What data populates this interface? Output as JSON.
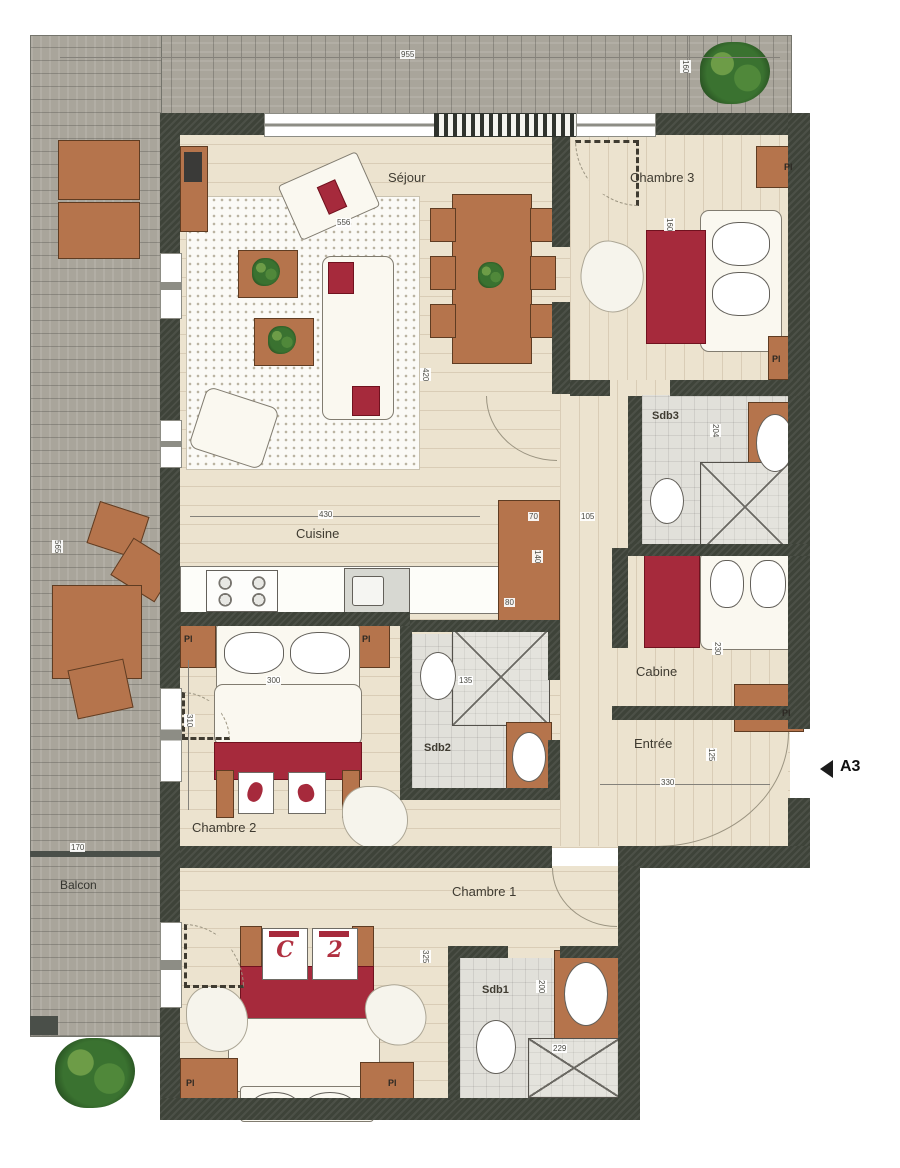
{
  "marker": {
    "label": "A3"
  },
  "labels": {
    "closet": "Pl"
  },
  "rooms": {
    "sejour": "Séjour",
    "chambre3": "Chambre 3",
    "cuisine": "Cuisine",
    "sdb3": "Sdb3",
    "cabine": "Cabine",
    "entree": "Entrée",
    "sdb2": "Sdb2",
    "chambre2": "Chambre 2",
    "chambre1": "Chambre 1",
    "sdb1": "Sdb1",
    "balcon": "Balcon"
  },
  "dimensions": {
    "top_width": "955",
    "balcony_top_depth": "160",
    "sejour_rug": "556",
    "sejour_depth": "420",
    "cuisine_width": "430",
    "hall_a": "70",
    "hall_b": "105",
    "closet_height": "140",
    "closet_width": "80",
    "sdb3_depth": "204",
    "chambre3_bed": "160",
    "chambre2_bed_width": "300",
    "chambre2_depth": "310",
    "cabine_depth": "230",
    "entree_depth": "125",
    "entree_width": "330",
    "balcon_depth": "170",
    "balcon_side_length": "565",
    "sdb2_shower": "135",
    "chambre1_depth": "325",
    "sdb1_depth": "200",
    "sdb1_width": "229"
  },
  "chambre1_pillows": {
    "left": "C",
    "right": "2"
  }
}
